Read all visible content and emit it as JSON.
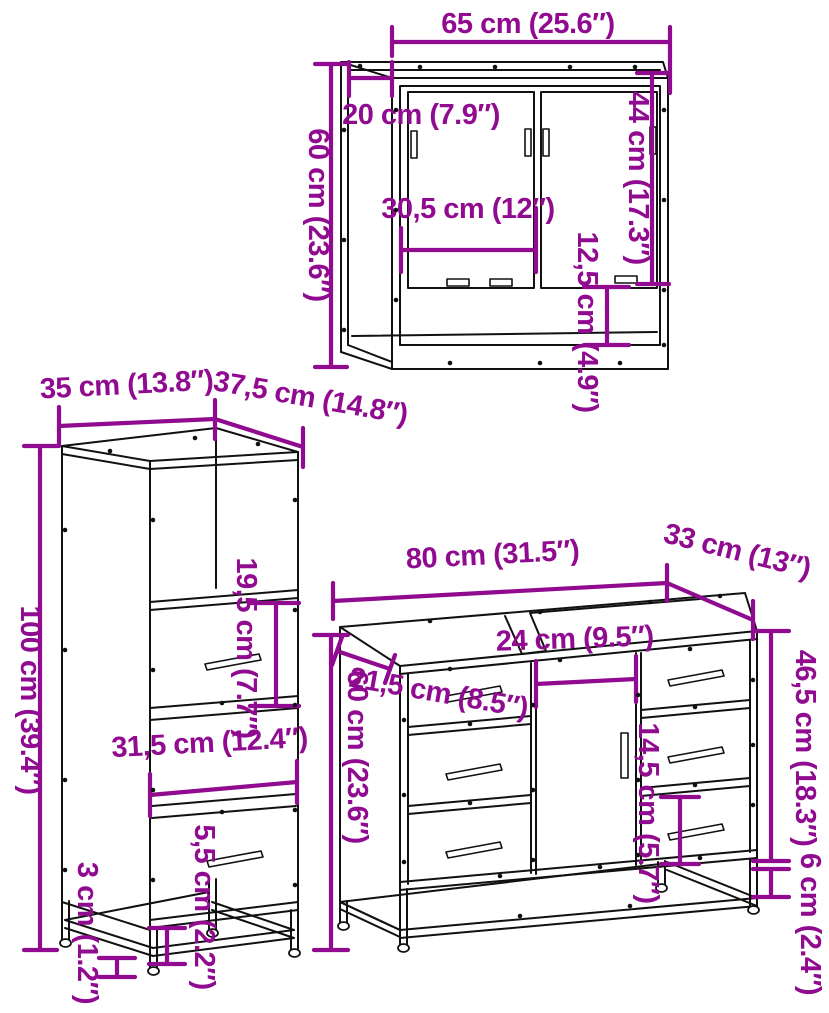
{
  "colors": {
    "background": "#ffffff",
    "line": "#111111",
    "dimension": "#900b90"
  },
  "pieces": {
    "mirror_cabinet": {
      "width": "65 cm (25.6″)",
      "depth": "20 cm (7.9″)",
      "height": "60 cm (23.6″)",
      "door_height": "44 cm (17.3″)",
      "inner_width": "30,5 cm (12″)",
      "shelf_height": "12,5 cm (4.9″)"
    },
    "tall_cabinet": {
      "width": "35 cm (13.8″)",
      "depth": "37,5 cm (14.8″)",
      "height": "100 cm (39.4″)",
      "drawer_height": "19,5 cm (7.7″)",
      "inner_width": "31,5 cm (12.4″)",
      "leg_height": "5,5 cm (2.2″)",
      "base_clearance": "3 cm (1.2″)"
    },
    "sink_cabinet": {
      "width": "80 cm (31.5″)",
      "depth": "33 cm (13″)",
      "height": "60 cm (23.6″)",
      "drawer_width": "21,5 cm (8.5″)",
      "door_width": "24 cm (9.5″)",
      "drawer_height": "14,5 cm (5.7″)",
      "side_height": "46,5 cm (18.3″)",
      "leg_height": "6 cm (2.4″)"
    }
  }
}
